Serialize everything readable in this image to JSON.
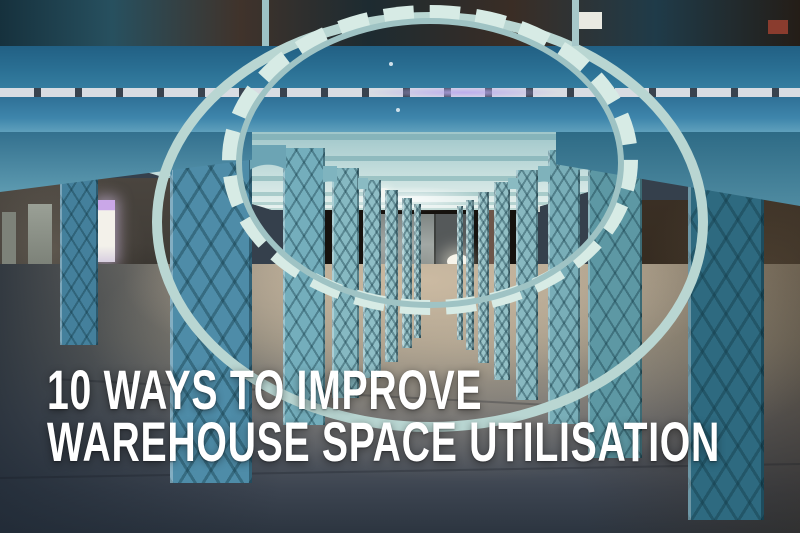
{
  "overlay": {
    "title_line1": "10 WAYS TO IMPROVE",
    "title_line2": "WAREHOUSE SPACE UTILISATION",
    "text_color": "#ffffff"
  },
  "scene": {
    "description": "Empty industrial warehouse interior with receding rows of teal steel lattice columns, arched roof truss and bare concrete floor",
    "graffiti_text": "BFA",
    "palette": {
      "beam_teal": "#2a6f93",
      "ceiling_pale": "#c5dedd",
      "column_teal_light": "#8fbec6",
      "column_teal_dark": "#2e6a80",
      "floor_tan": "#cbbaa2",
      "floor_shadow": "#2c3540",
      "wall_dark_left": "#3a3631",
      "wall_dark_right": "#2c2319"
    }
  }
}
